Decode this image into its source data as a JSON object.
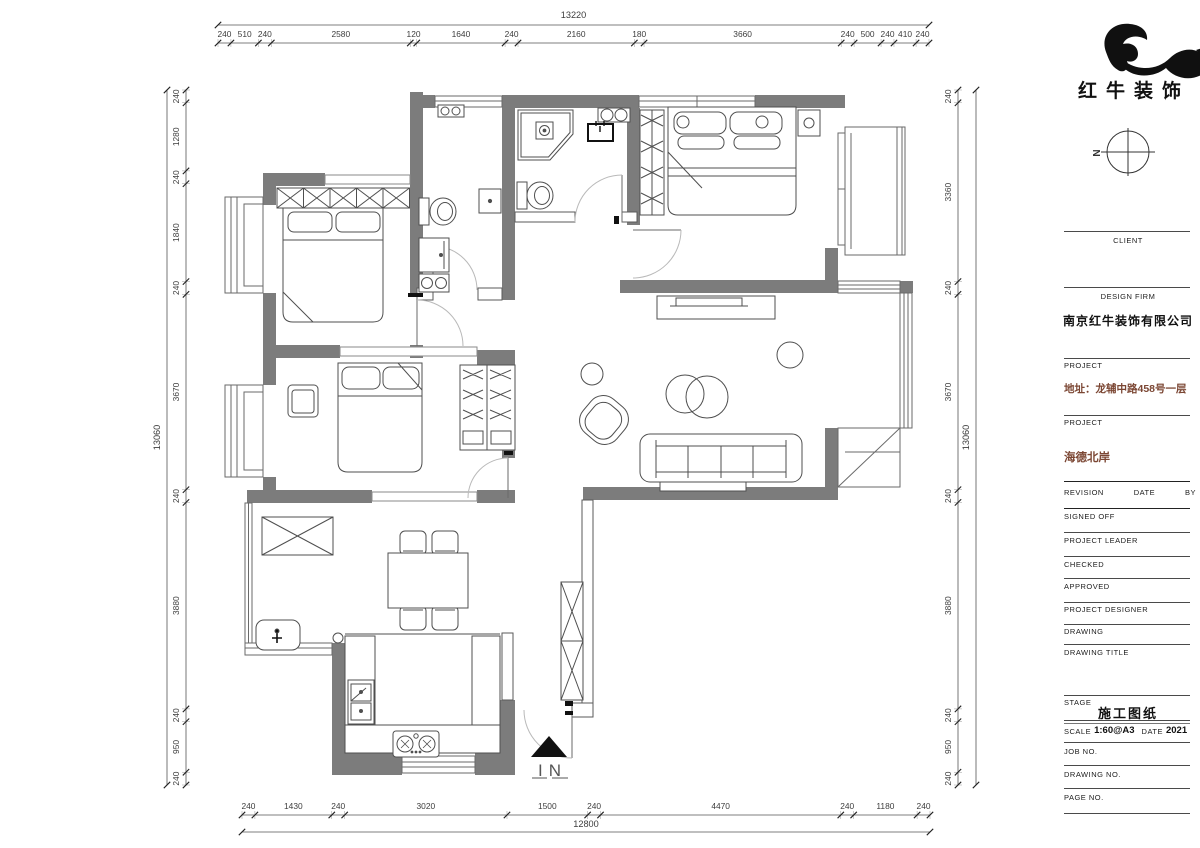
{
  "brand": {
    "logo_text": "红牛装饰",
    "compass_n": "N"
  },
  "plan": {
    "entrance_label": "IN"
  },
  "dimensions": {
    "top": {
      "total": "13220",
      "segments": [
        "240",
        "510",
        "240",
        "2580",
        "120",
        "1640",
        "240",
        "2160",
        "180",
        "3660",
        "240",
        "500",
        "240",
        "410",
        "240"
      ]
    },
    "left": {
      "total": "13060",
      "segments": [
        "240",
        "1280",
        "240",
        "1840",
        "240",
        "3670",
        "240",
        "3880",
        "240",
        "950",
        "240"
      ]
    },
    "right": {
      "total": "13060",
      "segments": [
        "240",
        "3360",
        "240",
        "3670",
        "240",
        "3880",
        "240",
        "950",
        "240"
      ]
    },
    "bottom": {
      "total": "12800",
      "segments": [
        "240",
        "1430",
        "240",
        "3020",
        "1500",
        "240",
        "4470",
        "240",
        "1180",
        "240"
      ]
    }
  },
  "title_block": {
    "client_label": "CLIENT",
    "design_firm_label": "DESIGN FIRM",
    "design_firm": "南京红牛装饰有限公司",
    "project_label_1": "PROJECT",
    "project_address": "地址：龙辅中路458号一层",
    "project_label_2": "PROJECT",
    "project_name": "海德北岸",
    "revision_label": "REVISION",
    "date_label": "DATE",
    "by_label": "BY",
    "signed_off_label": "SIGNED OFF",
    "project_leader_label": "PROJECT LEADER",
    "checked_label": "CHECKED",
    "approved_label": "APPROVED",
    "project_designer_label": "PROJECT DESIGNER",
    "drawing_label": "DRAWING",
    "drawing_title_label": "DRAWING TITLE",
    "stage_label": "STAGE",
    "stage_value": "施工图纸",
    "scale_label": "SCALE",
    "scale_value": "1:60@A3",
    "date2_label": "DATE",
    "date_value": "2021",
    "job_no_label": "JOB NO.",
    "drawing_no_label": "DRAWING NO.",
    "page_no_label": "PAGE NO."
  },
  "colors": {
    "wall": "#7c7c7c",
    "line": "#4f4f4f",
    "dim": "#3d3d3d",
    "door": "#b9b9b9",
    "accent_project": "#7b4633"
  }
}
